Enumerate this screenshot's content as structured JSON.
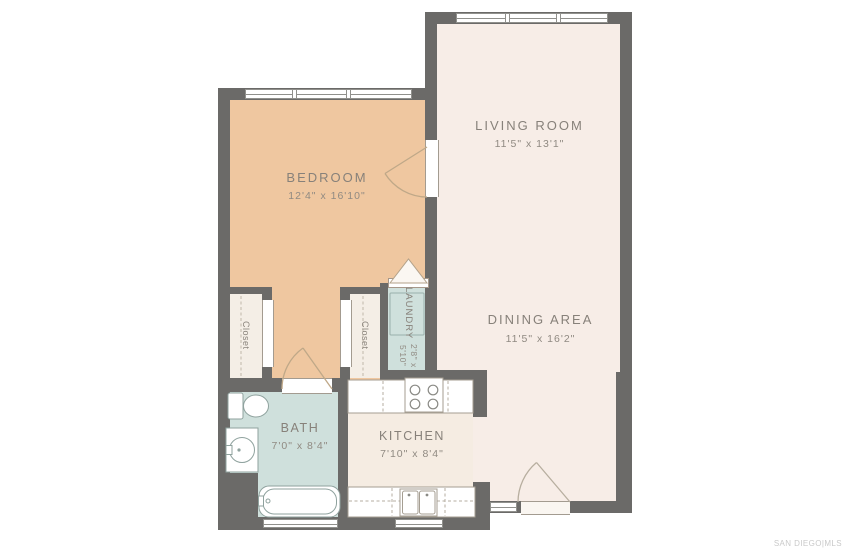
{
  "rooms": {
    "living": {
      "name": "LIVING ROOM",
      "dims": "11'5\" x 13'1\""
    },
    "bedroom": {
      "name": "BEDROOM",
      "dims": "12'4\" x 16'10\""
    },
    "dining": {
      "name": "DINING AREA",
      "dims": "11'5\" x 16'2\""
    },
    "laundry": {
      "name": "LAUNDRY",
      "dims": "2'8\" x 5'10\""
    },
    "bath": {
      "name": "BATH",
      "dims": "7'0\" x 8'4\""
    },
    "kitchen": {
      "name": "KITCHEN",
      "dims": "7'10\" x 8'4\""
    },
    "closet_left": {
      "name": "Closet"
    },
    "closet_right": {
      "name": "Closet"
    }
  },
  "watermark": "SAN DIEGO|MLS",
  "colors": {
    "wall": "#6b6a68",
    "bedroom_floor": "#efc7a0",
    "living_floor": "#f7ede7",
    "kitchen_floor": "#f5ece2",
    "wet_room_floor": "#cfe0dc",
    "closet_floor": "#f4eee6",
    "label_text": "#87817a",
    "watermark_text": "#c9c9c9",
    "fixture_line": "#8fa29e"
  }
}
